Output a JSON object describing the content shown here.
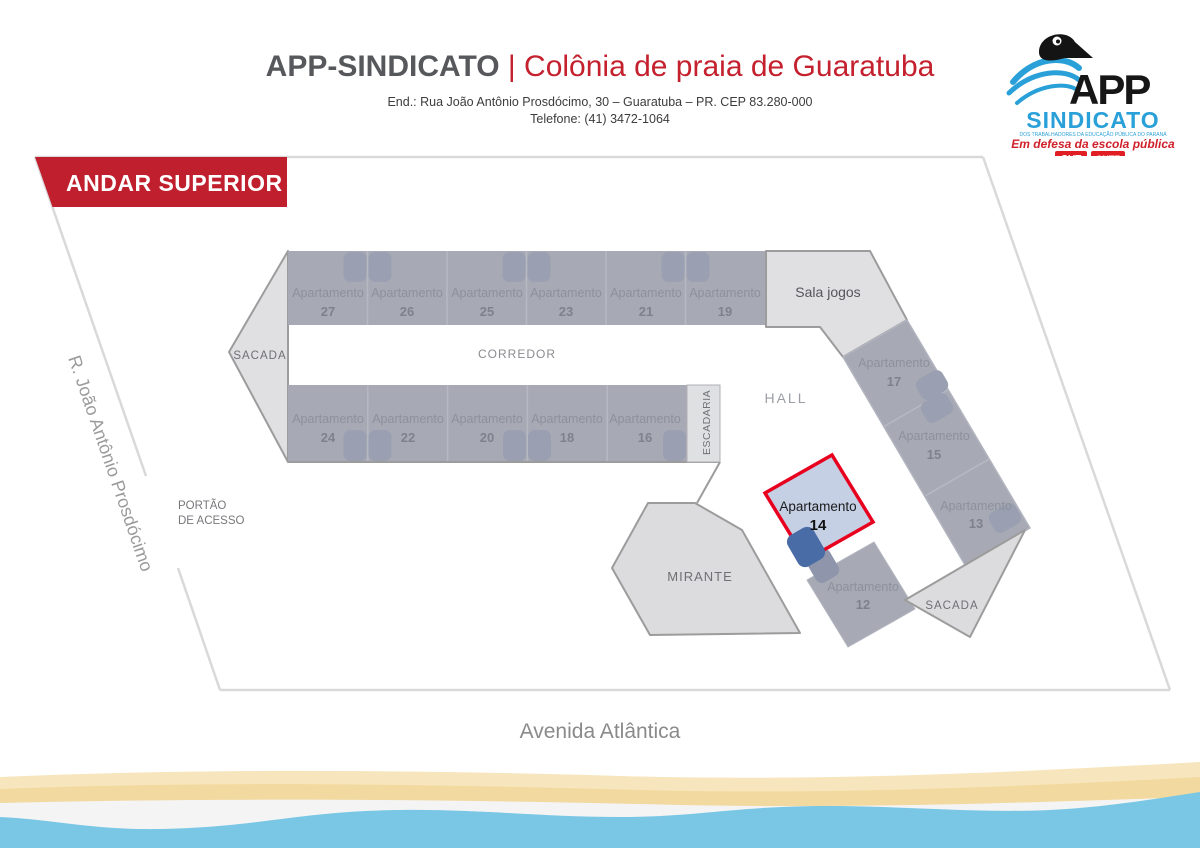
{
  "header": {
    "title_bold": "APP-SINDICATO ",
    "title_red": "| Colônia de praia de Guaratuba",
    "address": "End.: Rua João Antônio Prosdócimo, 30 – Guaratuba – PR. CEP 83.280-000",
    "phone": "Telefone: (41) 3472-1064"
  },
  "logo": {
    "app": "APP",
    "sindicato": "SINDICATO",
    "tagline": "DOS TRABALHADORES DA EDUCAÇÃO PÚBLICA DO PARANÁ",
    "slogan": "Em defesa da escola pública",
    "badge1": "CUT",
    "badge2": "CNTE"
  },
  "banner": {
    "label": "ANDAR SUPERIOR"
  },
  "plan": {
    "apartment_word": "Apartamento",
    "top_numbers": [
      "27",
      "26",
      "25",
      "23",
      "21",
      "19"
    ],
    "bottom_numbers": [
      "24",
      "22",
      "20",
      "18",
      "16"
    ],
    "wing_numbers": [
      "17",
      "15",
      "13"
    ],
    "apt14_number": "14",
    "apt12_number": "12",
    "labels": {
      "sacada_left": "SACADA",
      "corredor": "CORREDOR",
      "escadaria": "ESCADARIA",
      "hall": "HALL",
      "sala_jogos": "Sala jogos",
      "mirante": "MIRANTE",
      "sacada_right": "SACADA",
      "portao_line1": "PORTÃO",
      "portao_line2": "DE ACESSO"
    },
    "streets": {
      "left": "R. João Antônio Prosdócimo",
      "bottom": "Avenida Atlântica"
    }
  },
  "colors": {
    "banner_red": "#c01f2e",
    "highlight_red": "#e8001f",
    "room_gray": "#a7aab4",
    "room_light": "#e0e0e2",
    "bed_gray": "#9aa0b1",
    "highlight_blue": "#c5d0e5",
    "bed_blue": "#4a6ca6",
    "water_blue": "#79c7e5",
    "sand_dark": "#f2d9a0",
    "sand_light": "#f7e6bd"
  }
}
